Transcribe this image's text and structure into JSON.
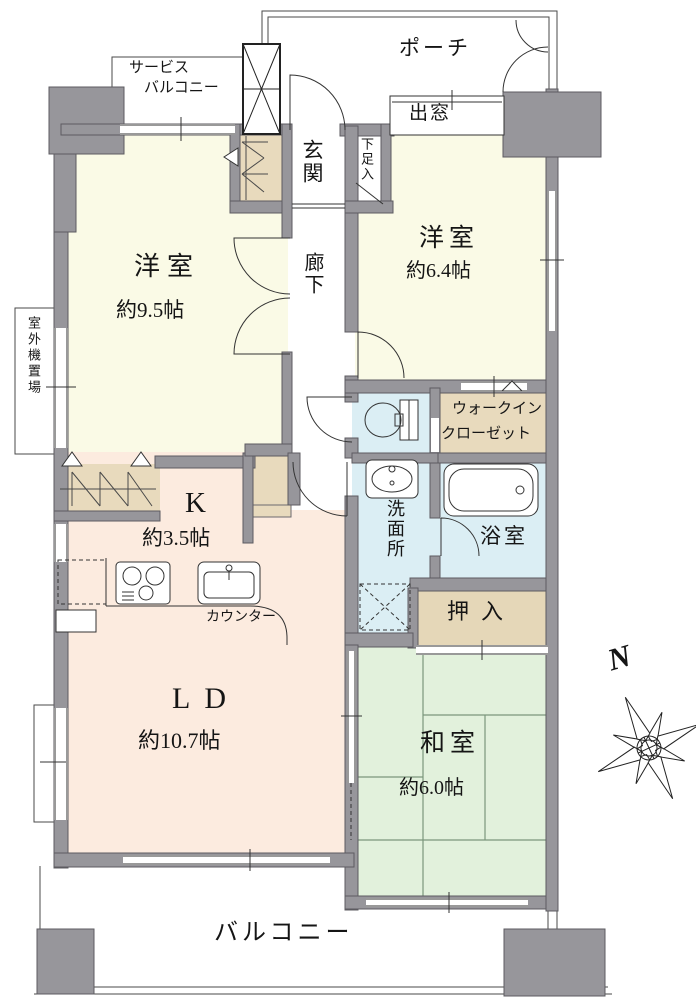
{
  "compass": {
    "north": "N"
  },
  "rooms": {
    "western_9_5": {
      "name": "洋室",
      "size": "約9.5帖"
    },
    "western_6_4": {
      "name": "洋室",
      "size": "約6.4帖"
    },
    "japanese_room": {
      "name": "和室",
      "size": "約6.0帖"
    },
    "living_dining": {
      "name": "LD",
      "size": "約10.7帖"
    },
    "kitchen": {
      "name": "K",
      "size": "約3.5帖",
      "counter": "カウンター"
    },
    "bathroom": {
      "name": "浴室"
    },
    "washroom": {
      "name": "洗面所"
    },
    "walk_in_closet": {
      "line1": "ウォークイン",
      "line2": "クローゼット"
    },
    "oshiire": {
      "name": "押入"
    },
    "entrance": {
      "name": "玄関"
    },
    "corridor": {
      "name": "廊下"
    },
    "shoe_cabinet": {
      "name": "下足入"
    }
  },
  "exterior": {
    "porch": "ポーチ",
    "bay_window": "出窓",
    "service_balcony_line1": "サービス",
    "service_balcony_line2": "バルコニー",
    "balcony": "バルコニー",
    "outdoor_unit_space": "室外機置場"
  },
  "colors": {
    "wall": "#97969b",
    "western_room": "#fafae6",
    "living_kitchen": "#fcebdf",
    "japanese_room": "#e2f1dc",
    "wet_room": "#dbeef4",
    "closet": "#e8dabd"
  }
}
